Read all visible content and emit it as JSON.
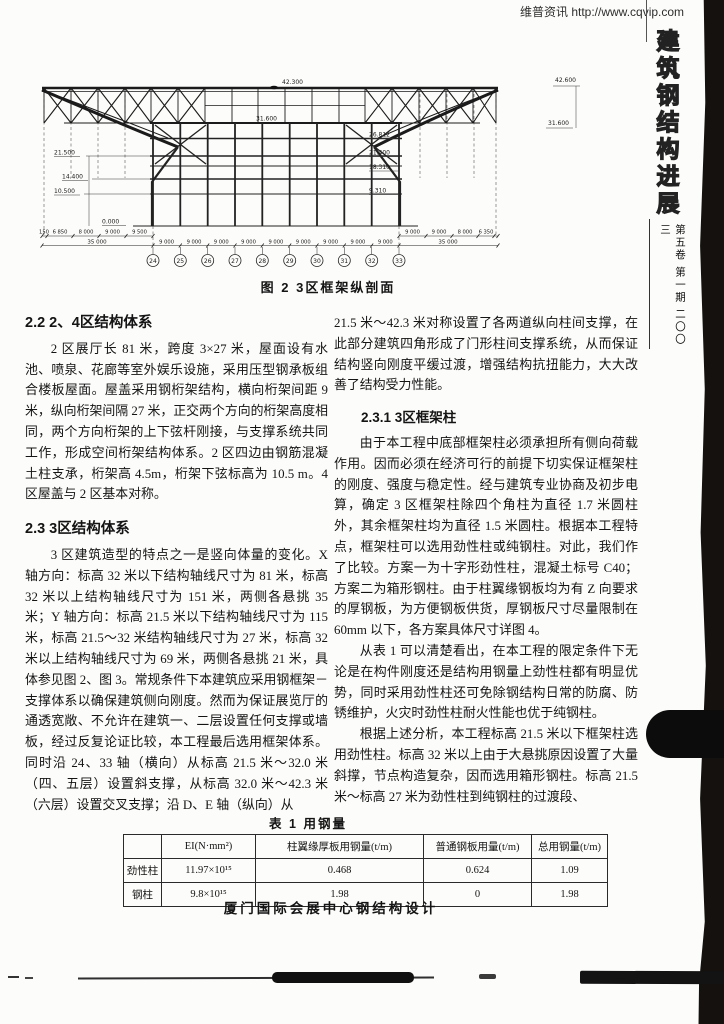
{
  "page": {
    "watermark": "维普资讯 http://www.cqvip.com",
    "footer_title": "厦门国际会展中心钢结构设计"
  },
  "sidebar": {
    "journal_title_chars": [
      "建",
      "筑",
      "钢",
      "结",
      "构",
      "进",
      "展"
    ],
    "issue_info": "第五卷 第一期 二〇〇三"
  },
  "figure": {
    "caption": "图 2  3区框架纵剖面",
    "elevations": {
      "top": "42.300",
      "top_right": "42.600",
      "right_31": "31.600",
      "mid_31": "31.600",
      "r26": "26.812",
      "r21": "21.400",
      "r18": "18.310",
      "r9": "9.310",
      "l21": "21.500",
      "l14": "14.400",
      "l10": "10.500",
      "l0": "0.000"
    },
    "grid_bubbles": [
      "24",
      "25",
      "26",
      "27",
      "28",
      "29",
      "30",
      "31",
      "32",
      "33"
    ],
    "bay_dims": [
      "9 000",
      "9 000",
      "9 000",
      "9 000",
      "9 000",
      "9 000",
      "9 000",
      "9 000",
      "9 000"
    ],
    "left_chain": [
      "150",
      "6 850",
      "8 000",
      "9 000",
      "9 500"
    ],
    "right_chain": [
      "9 000",
      "9 000",
      "8 000",
      "6 350"
    ],
    "total_left": "35 000",
    "total_right": "35 000"
  },
  "left_column": {
    "heading1": "2.2  2、4区结构体系",
    "para1": "2 区展厅长 81 米，跨度 3×27 米，屋面设有水池、喷泉、花廊等室外娱乐设施，采用压型钢承板组合楼板屋面。屋盖采用钢桁架结构，横向桁架间距 9 米，纵向桁架间隔 27 米，正交两个方向的桁架高度相同，两个方向桁架的上下弦杆刚接，与支撑系统共同工作，形成空间桁架结构体系。2 区四边由钢筋混凝土柱支承，桁架高 4.5m，桁架下弦标高为 10.5 m。4 区屋盖与 2 区基本对称。",
    "heading2": "2.3  3区结构体系",
    "para2": "3 区建筑造型的特点之一是竖向体量的变化。X 轴方向：标高 32 米以下结构轴线尺寸为 81 米，标高 32 米以上结构轴线尺寸为 151 米，两侧各悬挑 35 米；Y 轴方向：标高 21.5 米以下结构轴线尺寸为 115 米，标高 21.5～32 米结构轴线尺寸为 27 米，标高 32 米以上结构轴线尺寸为 69 米，两侧各悬挑 21 米，具体参见图 2、图 3。常规条件下本建筑应采用钢框架－支撑体系以确保建筑侧向刚度。然而为保证展览厅的通透宽敞、不允许在建筑一、二层设置任何支撑或墙板，经过反复论证比较，本工程最后选用框架体系。同时沿 24、33 轴（横向）从标高 21.5 米～32.0 米（四、五层）设置斜支撑，从标高 32.0 米～42.3 米（六层）设置交叉支撑；沿 D、E 轴（纵向）从"
  },
  "right_column": {
    "para_continued": "21.5 米～42.3 米对称设置了各两道纵向柱间支撑，在此部分建筑四角形成了门形柱间支撑系统，从而保证结构竖向刚度平缓过渡，增强结构抗扭能力，大大改善了结构受力性能。",
    "heading": "2.3.1  3区框架柱",
    "para1": "由于本工程中底部框架柱必须承担所有侧向荷载作用。因而必须在经济可行的前提下切实保证框架柱的刚度、强度与稳定性。经与建筑专业协商及初步电算，确定 3 区框架柱除四个角柱为直径 1.7 米圆柱外，其余框架柱均为直径 1.5 米圆柱。根据本工程特点，框架柱可以选用劲性柱或纯钢柱。对此，我们作了比较。方案一为十字形劲性柱，混凝土标号 C40；方案二为箱形钢柱。由于柱翼缘钢板均为有 Z 向要求的厚钢板，为方便钢板供货，厚钢板尺寸尽量限制在 60mm 以下，各方案具体尺寸详图 4。",
    "para2": "从表 1 可以清楚看出，在本工程的限定条件下无论是在构件刚度还是结构用钢量上劲性柱都有明显优势，同时采用劲性柱还可免除钢结构日常的防腐、防锈维护，火灾时劲性柱耐火性能也优于纯钢柱。",
    "para3": "根据上述分析，本工程标高 21.5 米以下框架柱选用劲性柱。标高 32 米以上由于大悬挑原因设置了大量斜撑，节点构造复杂，因而选用箱形钢柱。标高 21.5 米～标高 27 米为劲性柱到纯钢柱的过渡段、"
  },
  "table": {
    "title": "表 1  用钢量",
    "headers": [
      "",
      "EI(N·mm²)",
      "柱翼缘厚板用钢量(t/m)",
      "普通钢板用量(t/m)",
      "总用钢量(t/m)"
    ],
    "rows": [
      {
        "label": "劲性柱",
        "cells": [
          "11.97×10¹⁵",
          "0.468",
          "0.624",
          "1.09"
        ]
      },
      {
        "label": "钢柱",
        "cells": [
          "9.8×10¹⁵",
          "1.98",
          "0",
          "1.98"
        ]
      }
    ]
  }
}
